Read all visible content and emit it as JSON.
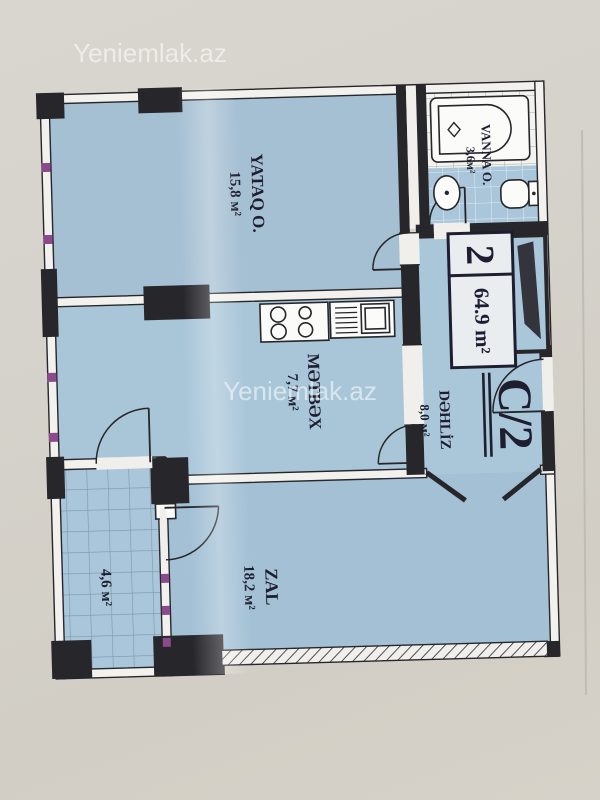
{
  "watermark": {
    "text": "Yeniemlak.az"
  },
  "badge": {
    "room_count": "2",
    "total_area": "64.9 m²"
  },
  "plan_code": "C/2",
  "rooms": {
    "bedroom": {
      "name": "YATAQ O.",
      "area": "15,8 м²"
    },
    "bathroom": {
      "name": "VANNA O.",
      "area": "3,6м²"
    },
    "hallway": {
      "name": "DƏHLİZ",
      "area": "8,0 м²"
    },
    "kitchen": {
      "name": "MƏTBƏX",
      "area": "7,7 м²"
    },
    "living_room": {
      "name": "ZAL",
      "area": "18,2 м²"
    },
    "balcony": {
      "area": "4,6 м²"
    }
  }
}
